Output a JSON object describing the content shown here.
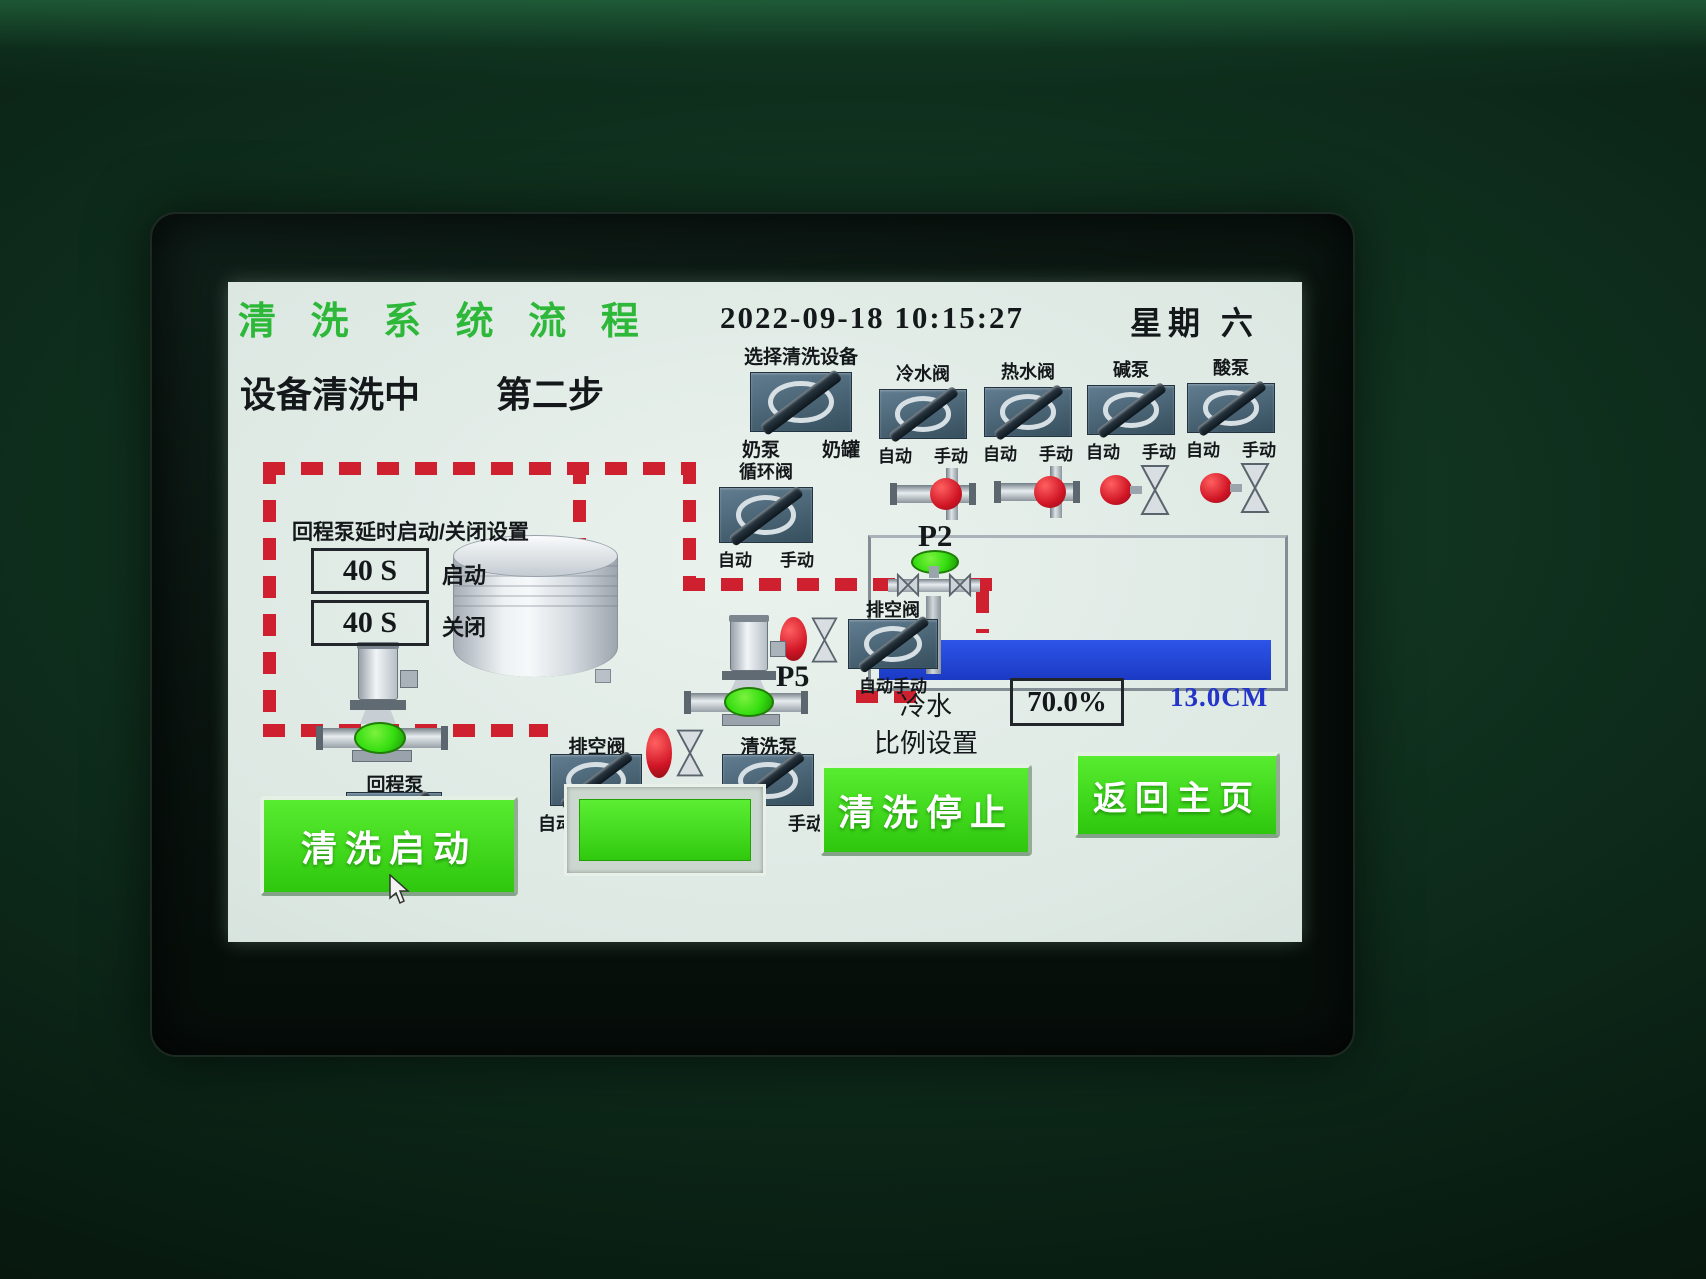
{
  "header": {
    "title": "清 洗 系 统 流 程",
    "datetime": "2022-09-18 10:15:27",
    "weekday": "星期 六"
  },
  "status": {
    "text": "设备清洗中",
    "step": "第二步"
  },
  "device_select": {
    "label": "选择清洗设备",
    "left_option": "奶泵",
    "right_option": "奶罐"
  },
  "auto_label": "自动",
  "manual_label": "手动",
  "auto_manual_joined": "自动手动",
  "top_valves": [
    {
      "name": "冷水阀"
    },
    {
      "name": "热水阀"
    },
    {
      "name": "碱泵"
    },
    {
      "name": "酸泵"
    }
  ],
  "circulation_valve": {
    "label": "循环阀"
  },
  "drain_valve_right": {
    "label": "排空阀"
  },
  "drain_valve_center": {
    "label": "排空阀"
  },
  "clean_pump": {
    "label": "清洗泵"
  },
  "return_pump": {
    "label": "回程泵"
  },
  "timer_panel": {
    "title": "回程泵延时启动/关闭设置",
    "start_value": "40 S",
    "start_label": "启动",
    "close_value": "40 S",
    "close_label": "关闭"
  },
  "points": {
    "p1": "P1",
    "p2": "P2",
    "p5": "P5"
  },
  "cold_water": {
    "line1": "冷水",
    "line2": "比例设置",
    "percent": "70.0%",
    "level": "13.0CM"
  },
  "buttons": {
    "start": "清洗启动",
    "stop": "清洗停止",
    "home": "返回主页"
  },
  "colors": {
    "title_green": "#2eb83a",
    "pipe_red": "#cf2030",
    "indicator_green": "#35dd10",
    "water_blue": "#2046d8",
    "button_green": "#3fdd17",
    "level_text_blue": "#2335c8"
  }
}
